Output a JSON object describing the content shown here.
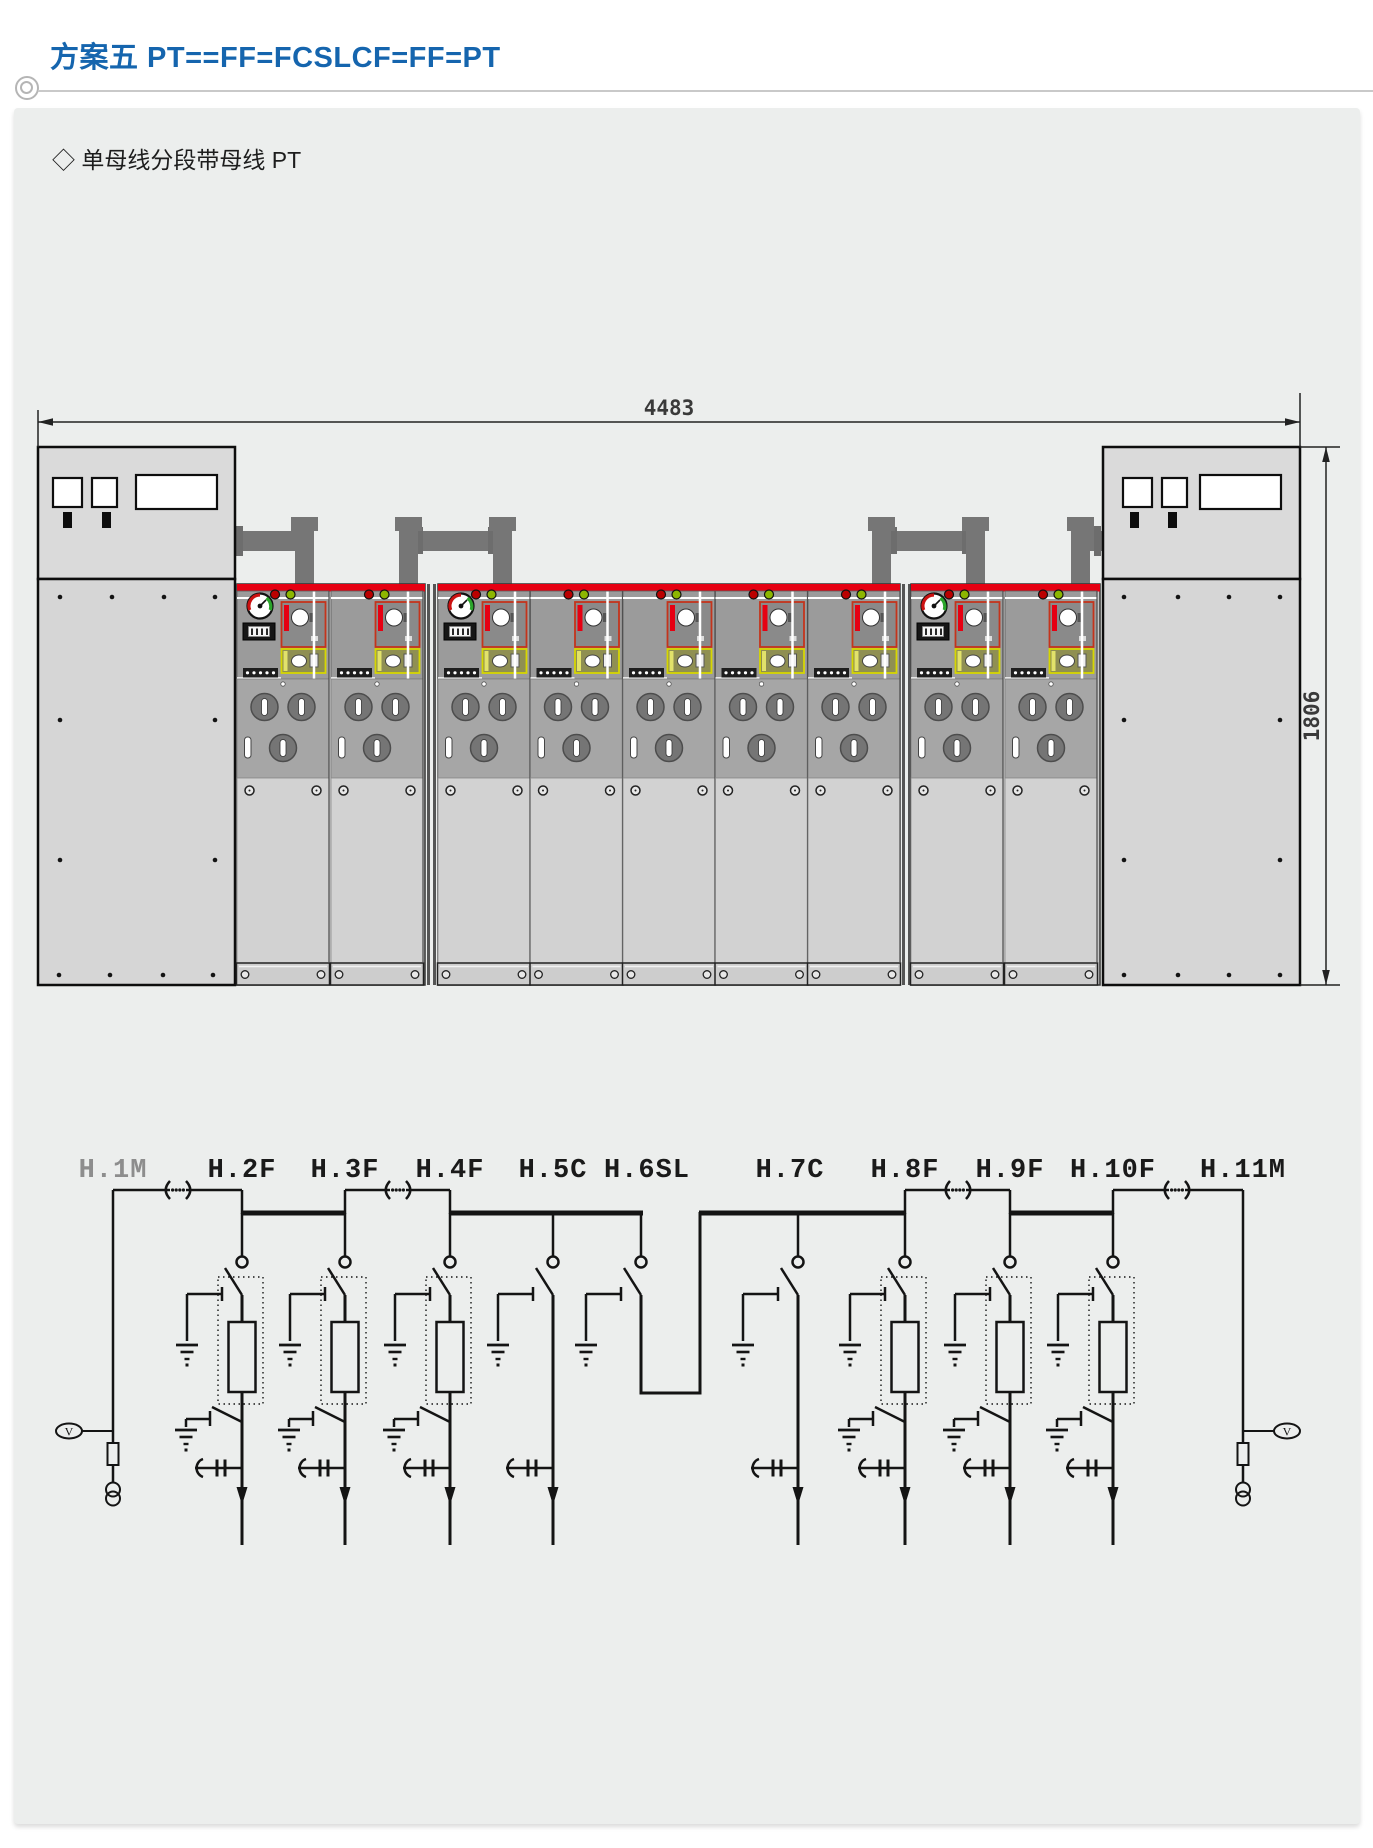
{
  "header": {
    "title": "方案五 PT==FF=FCSLCF=FF=PT"
  },
  "content": {
    "subtitle_marker": "◇",
    "subtitle": "单母线分段带母线 PT",
    "elevation": {
      "width_dim": "4483",
      "height_dim": "1806",
      "cabinet_groups": [
        "PT cabinet",
        "2-panel group",
        "5-panel group",
        "2-panel group",
        "PT cabinet"
      ]
    },
    "schematic": {
      "voltmeter_label": "V",
      "columns": [
        {
          "label": "H.1M",
          "kind": "busbar-PT-metering",
          "muted": true
        },
        {
          "label": "H.2F",
          "kind": "fuse-feeder"
        },
        {
          "label": "H.3F",
          "kind": "fuse-feeder"
        },
        {
          "label": "H.4F",
          "kind": "fuse-feeder"
        },
        {
          "label": "H.5C",
          "kind": "cable-switch"
        },
        {
          "label": "H.6SL",
          "kind": "section-link"
        },
        {
          "label": "H.7C",
          "kind": "cable-switch"
        },
        {
          "label": "H.8F",
          "kind": "fuse-feeder"
        },
        {
          "label": "H.9F",
          "kind": "fuse-feeder"
        },
        {
          "label": "H.10F",
          "kind": "fuse-feeder"
        },
        {
          "label": "H.11M",
          "kind": "busbar-PT-metering"
        }
      ]
    },
    "colors": {
      "accent_blue": "#1565ae",
      "busbar_red": "#e60012",
      "indicator_red": "#bb0000",
      "indicator_green": "#8db600",
      "panel_gray": "#9b9b9b"
    }
  }
}
